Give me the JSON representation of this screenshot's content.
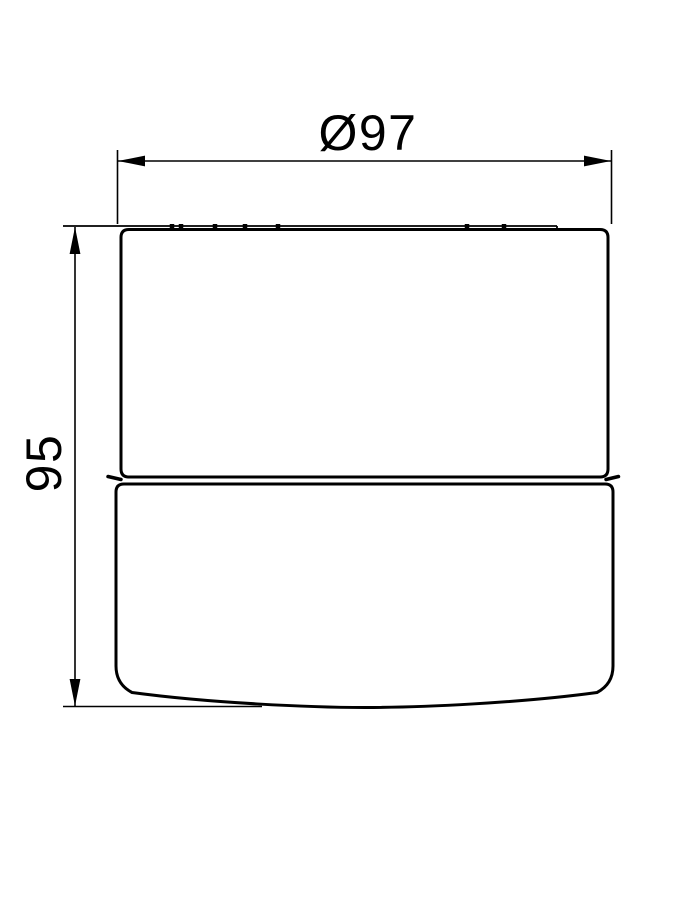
{
  "drawing": {
    "type": "technical-dimension-drawing",
    "background_color": "#ffffff",
    "line_color": "#000000",
    "dimensions": {
      "diameter": {
        "label": "Ø97",
        "value": 97
      },
      "height": {
        "label": "95",
        "value": 95
      }
    }
  }
}
